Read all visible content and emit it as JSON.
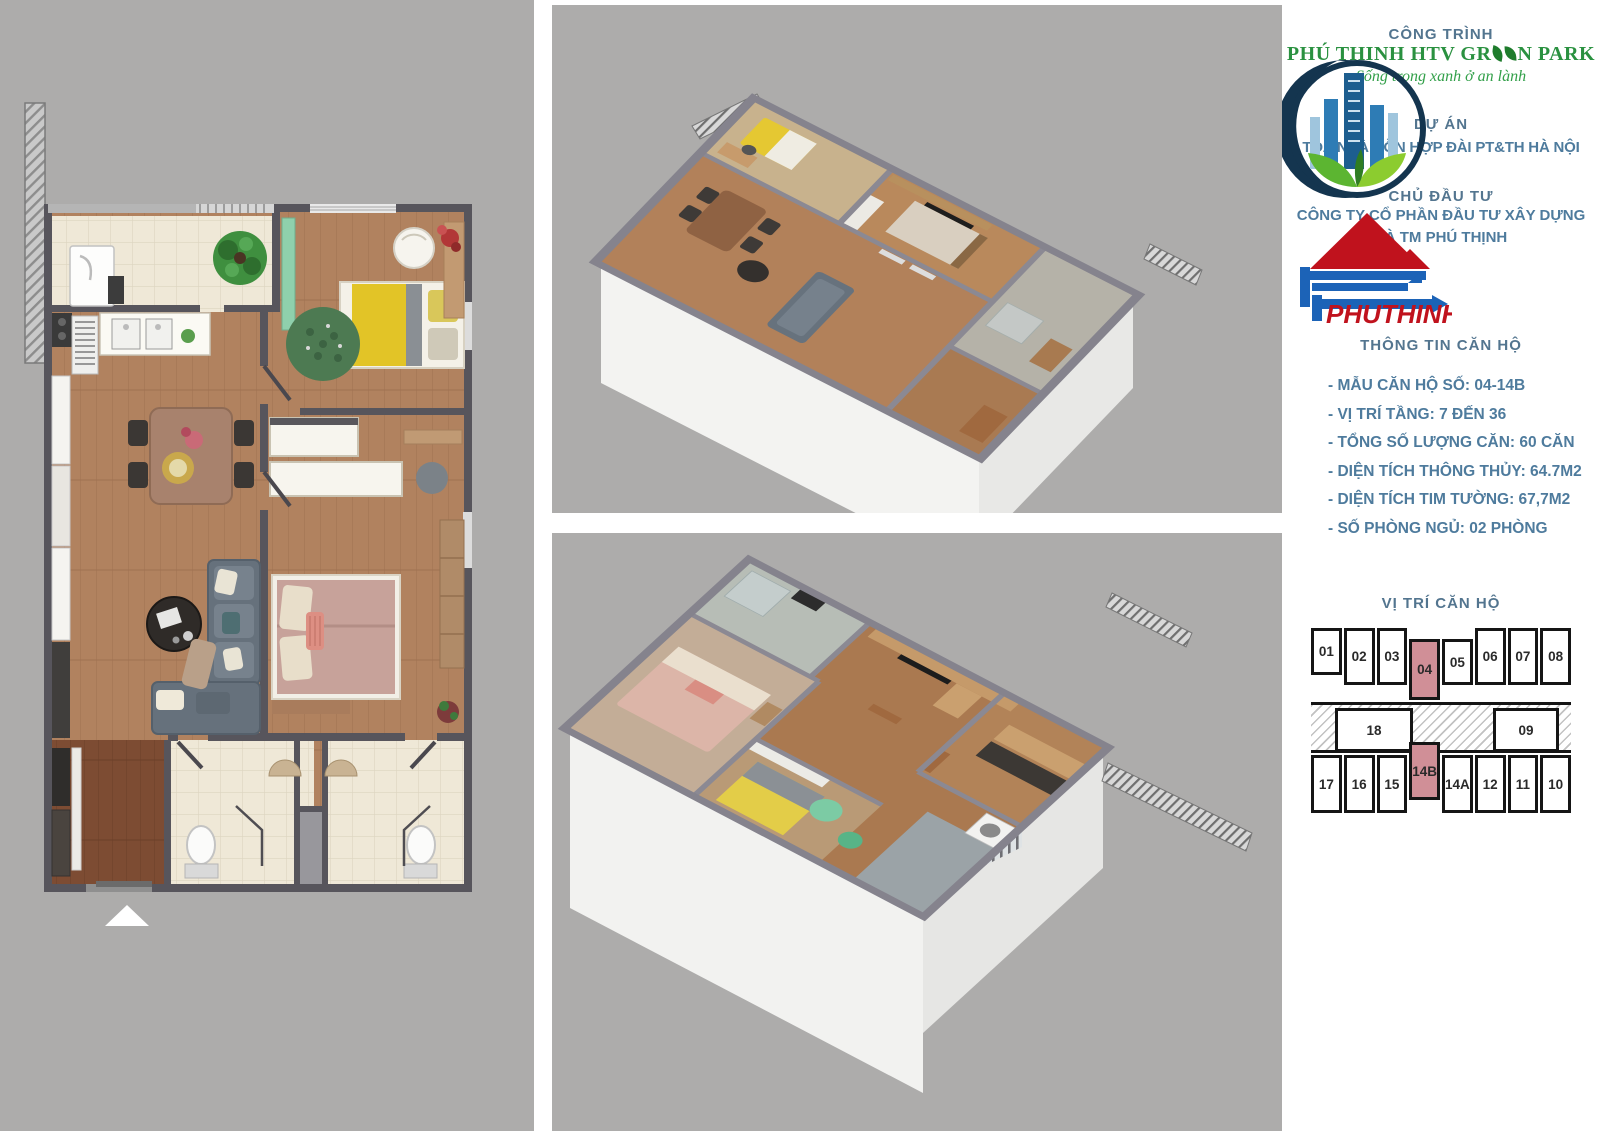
{
  "page": {
    "background": "#adacab",
    "panel_white": "#ffffff"
  },
  "header": {
    "construction_label": "CÔNG TRÌNH"
  },
  "brand": {
    "logo_icon": "crescent-city-buildings-leaves-logo",
    "name_pre": "PHÚ THỊNH HTV GR",
    "name_post": "N PARK",
    "tagline": "Sống trong xanh ở an lành",
    "green_text": "#2a9140"
  },
  "project": {
    "label": "DỰ ÁN",
    "name": "TÒA NHÀ HỖN HỢP ĐÀI PT&TH HÀ NỘI"
  },
  "investor": {
    "label": "CHỦ ĐẦU TƯ",
    "logo_icon": "red-roof-blue-arrow-logo",
    "logo_text": "PHUTHINH",
    "company_line1": "CÔNG TY CỔ PHẦN ĐẦU TƯ XÂY DỰNG",
    "company_line2": "VÀ TM PHÚ THỊNH",
    "red": "#c0121d",
    "blue": "#1c63b7"
  },
  "apartment_info": {
    "title": "THÔNG TIN CĂN HỘ",
    "items": [
      "- MẪU CĂN HỘ SỐ: 04-14B",
      "- VỊ TRÍ TẦNG: 7 ĐẾN 36",
      "- TỔNG SỐ LƯỢNG CĂN: 60 CĂN",
      "- DIỆN TÍCH THÔNG THỦY: 64.7M2",
      "- DIỆN TÍCH TIM TƯỜNG: 67,7M2",
      "- SỐ PHÒNG NGỦ: 02 PHÒNG"
    ]
  },
  "unit_map": {
    "title": "VỊ TRÍ CĂN HỘ",
    "top_row": [
      "01",
      "02",
      "03",
      "04",
      "05",
      "06",
      "07",
      "08"
    ],
    "middle_row": [
      "18",
      "09"
    ],
    "bottom_row": [
      "17",
      "16",
      "15",
      "14B",
      "14A",
      "12",
      "11",
      "10"
    ],
    "highlighted_units": [
      "04",
      "14B"
    ],
    "highlight_color": "#d08f97"
  },
  "colors": {
    "text_blue": "#4e7b9d"
  }
}
